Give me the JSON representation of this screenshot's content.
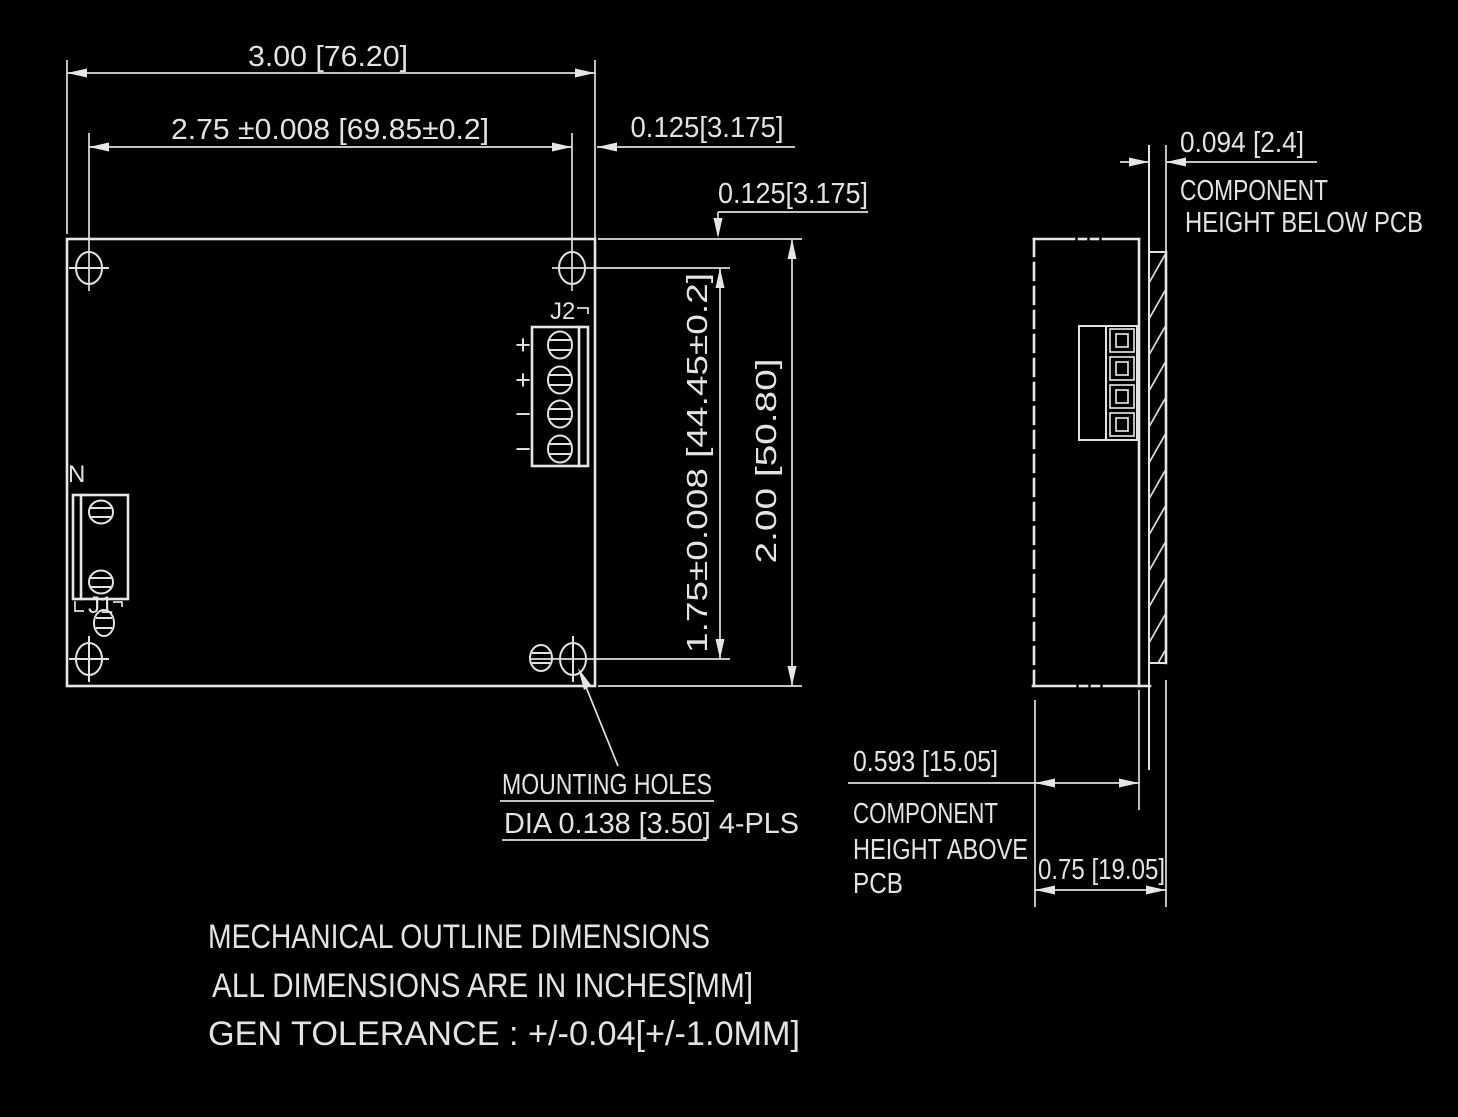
{
  "drawing": {
    "background": "#000000",
    "line_color": "#e6e6e6",
    "top_view": {
      "dim_width": "3.00 [76.20]",
      "dim_hole_span_x": "2.75 ±0.008 [69.85±0.2]",
      "dim_hole_offset_x": "0.125[3.175]",
      "dim_hole_offset_y": "0.125[3.175]",
      "dim_hole_span_y": "1.75±0.008 [44.45±0.2]",
      "dim_height": "2.00 [50.80]",
      "connector_j2": {
        "label": "J2",
        "pin_labels": [
          "+",
          "+",
          "−",
          "−"
        ]
      },
      "connector_j1": {
        "label": "J1",
        "line_label": "N"
      },
      "mounting_note": {
        "line1": "MOUNTING HOLES",
        "line2": "DIA 0.138 [3.50] 4-PLS"
      }
    },
    "side_view": {
      "dim_below_pcb": "0.094 [2.4]",
      "below_pcb_caption": [
        "COMPONENT",
        "HEIGHT BELOW PCB"
      ],
      "dim_above_pcb": "0.593 [15.05]",
      "above_pcb_caption": [
        "COMPONENT",
        "HEIGHT ABOVE",
        "PCB"
      ],
      "dim_total_height": "0.75 [19.05]"
    },
    "footer_notes": [
      "MECHANICAL OUTLINE DIMENSIONS",
      "ALL DIMENSIONS ARE IN INCHES[MM]",
      "GEN TOLERANCE : +/-0.04[+/-1.0MM]"
    ]
  }
}
